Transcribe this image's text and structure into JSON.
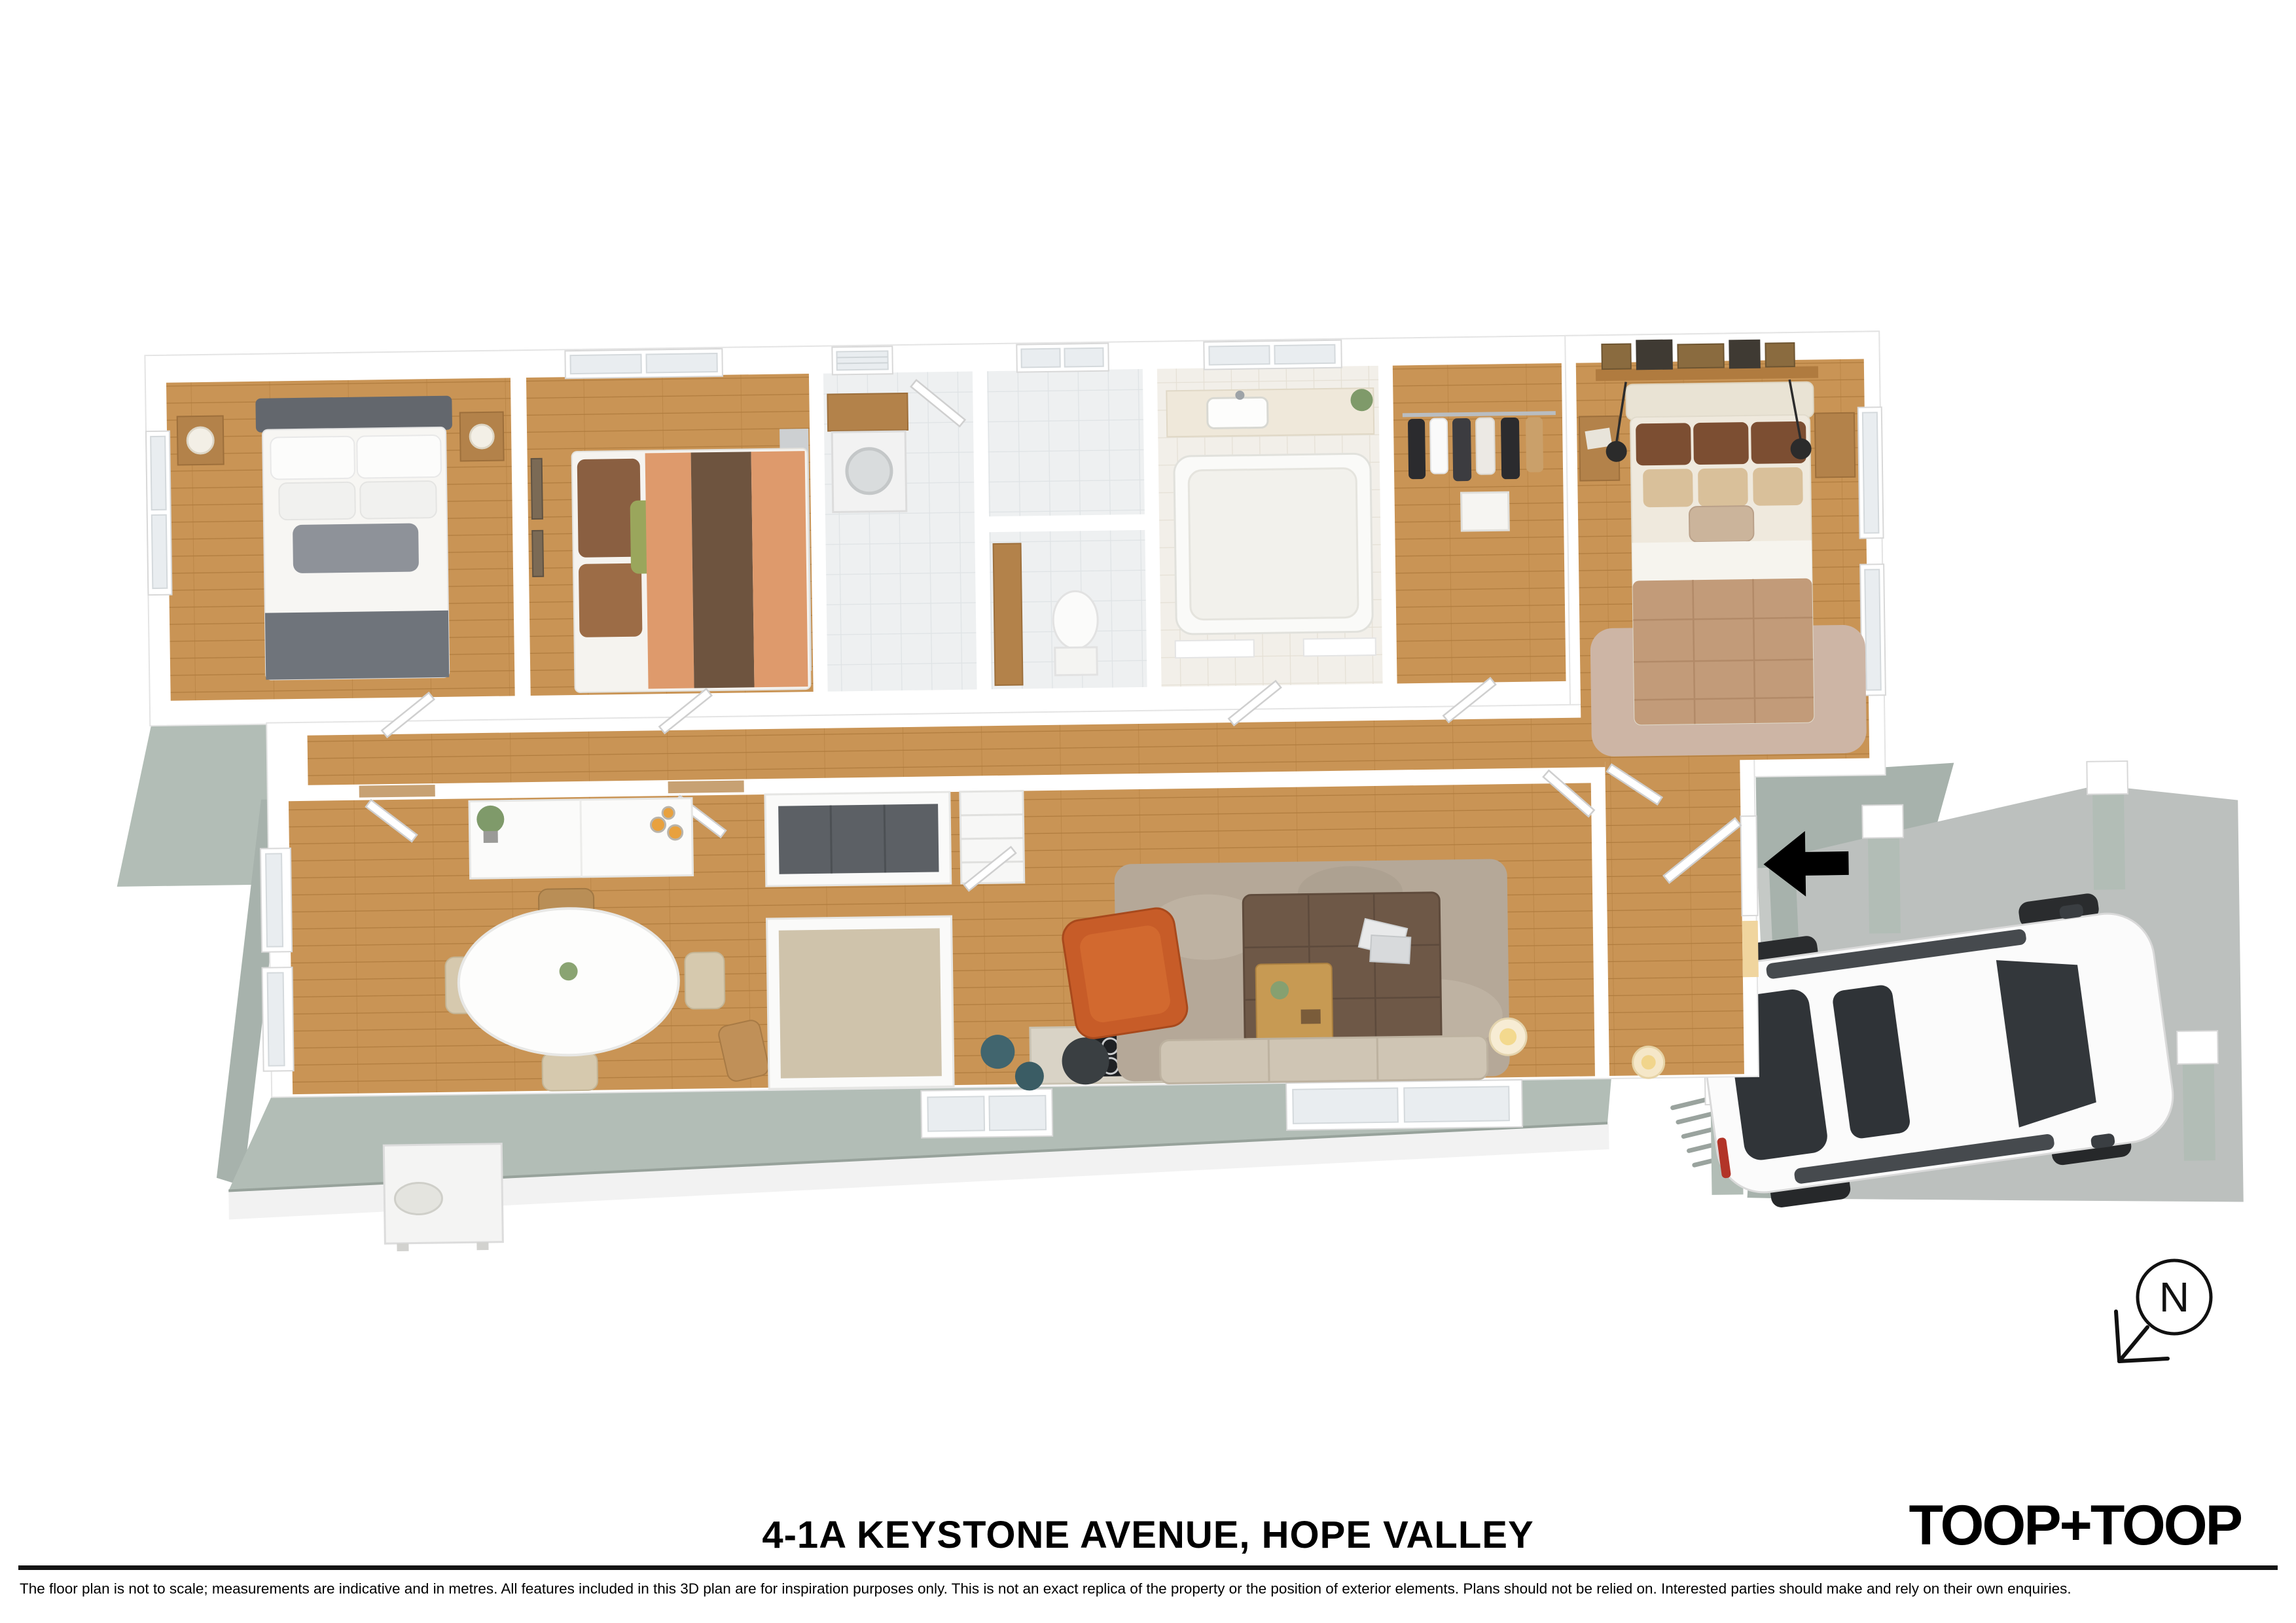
{
  "footer": {
    "address_title": "4-1A KEYSTONE AVENUE, HOPE VALLEY",
    "brand_wordmark": "TOOP+TOOP",
    "disclaimer": "The floor plan is not to scale; measurements are indicative and in metres. All features included in this 3D plan are for inspiration purposes only. This is not an exact replica of the property or the position of exterior elements. Plans should not be relied on. Interested parties should make and rely on their own enquiries."
  },
  "compass": {
    "label": "N",
    "icon": "north-compass-arrow-icon",
    "arrow_direction": "south-west"
  },
  "entry_marker": {
    "icon": "entry-direction-arrow-icon",
    "arrow_direction": "left",
    "color": "#000000"
  },
  "palette": {
    "page_background": "#ffffff",
    "interior_walls": "#ffffff",
    "exterior_walls": "#b2bdb6",
    "timber_floor": "#c99455",
    "tile_floor": "#eef0f1",
    "carport_slab": "#bcc0be",
    "accent_armchair": "#c75c28",
    "ottoman": "#6e5847",
    "living_rug": "#b5a898",
    "footer_text": "#000000"
  },
  "floorplan": {
    "style": "3d-top-down-dollhouse-render",
    "rooms": [
      {
        "id": "bedroom-1",
        "contents": [
          "double-bed-grey-white",
          "two-bedside-tables",
          "table-lamps",
          "window-left-wall"
        ]
      },
      {
        "id": "bedroom-2",
        "contents": [
          "bed-striped-orange-brown-duvet",
          "wall-art-frames",
          "window-top-wall",
          "grey-rug"
        ]
      },
      {
        "id": "laundry",
        "contents": [
          "washing-machine",
          "timber-bench",
          "louvre-window",
          "open-door"
        ]
      },
      {
        "id": "wc",
        "contents": [
          "toilet",
          "timber-vanity",
          "window-top-wall"
        ]
      },
      {
        "id": "bathroom",
        "contents": [
          "bathtub",
          "vanity-basin-tap",
          "window-top-wall",
          "plant"
        ]
      },
      {
        "id": "walk-in-robe",
        "contents": [
          "hanging-rail-with-clothes",
          "storage-box"
        ]
      },
      {
        "id": "master-bedroom",
        "contents": [
          "bed-tan-quilt",
          "picture-ledge-with-frames",
          "two-bedside-tables",
          "black-pendant-lamps",
          "fluffy-rug",
          "two-windows-right-wall"
        ]
      },
      {
        "id": "hallway",
        "contents": [
          "timber-floor",
          "internal-doors"
        ]
      },
      {
        "id": "dining",
        "contents": [
          "oval-dining-table",
          "five-chairs",
          "white-sideboard",
          "candles",
          "plant",
          "two-windows-left-wall"
        ]
      },
      {
        "id": "kitchen",
        "contents": [
          "fridge-peninsula",
          "stone-top-bench",
          "pantry-with-shelves",
          "cooktop-four-burners",
          "stools"
        ]
      },
      {
        "id": "living",
        "contents": [
          "shag-rug",
          "brown-ottoman-coffee-table",
          "timber-tray",
          "magazines",
          "orange-armchair",
          "side-table",
          "sofa",
          "floor-lamp",
          "window-bottom-wall"
        ]
      },
      {
        "id": "entry",
        "contents": [
          "front-door-with-sidelight-glow",
          "table-lamp"
        ]
      },
      {
        "id": "carport",
        "contents": [
          "white-suv",
          "four-posts",
          "concrete-slab",
          "kerb",
          "drain-grate"
        ]
      }
    ],
    "exterior_features": [
      "air-conditioning-unit",
      "sage-green-external-walls",
      "porch-with-entry-arrow"
    ]
  }
}
